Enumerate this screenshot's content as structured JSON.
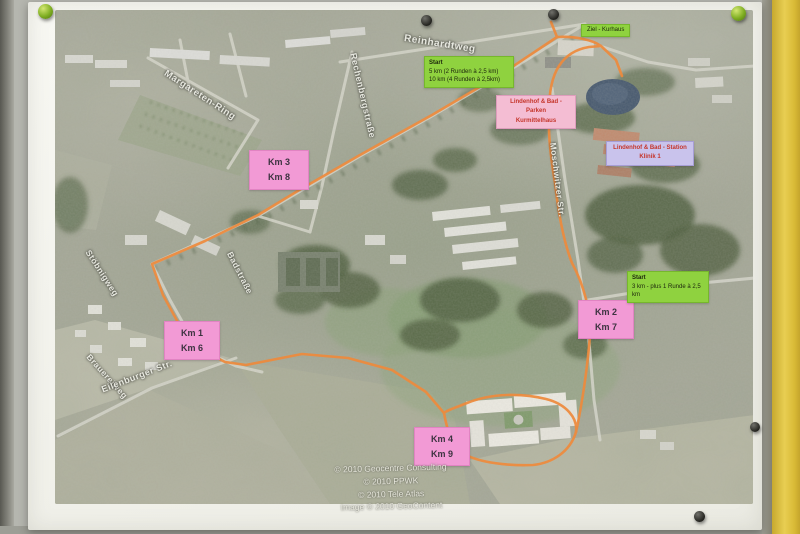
{
  "board": {
    "pins": [
      "green-pin-top-left",
      "black-pin-top-center-left",
      "black-pin-top-center-right",
      "green-pin-top-right",
      "black-pin-right-middle",
      "black-pin-bottom-right"
    ]
  },
  "map": {
    "km_markers": [
      {
        "line1": "Km 3",
        "line2": "Km 8"
      },
      {
        "line1": "Km 1",
        "line2": "Km 6"
      },
      {
        "line1": "Km 2",
        "line2": "Km 7"
      },
      {
        "line1": "Km 4",
        "line2": "Km 9"
      }
    ],
    "start_box_main": {
      "line1": "Start",
      "line2": "5 km (2 Runden à 2,5 km)",
      "line3": "10 km (4 Runden à 2,5km)"
    },
    "start_box_secondary": {
      "line1": "Start",
      "line2": "3 km - plus 1 Runde à 2,5 km"
    },
    "finish_box": {
      "label": "Ziel - Kurhaus"
    },
    "info_box_parken": {
      "line1": "Lindenhof & Bad - Parken",
      "line2": "Kurmittelhaus"
    },
    "info_box_station": {
      "line1": "Lindenhof & Bad - Station",
      "line2": "Klinik 1"
    },
    "street_labels": [
      {
        "text": "Reinhardtweg"
      },
      {
        "text": "Margareten-Ring"
      },
      {
        "text": "Rechenbergstraße"
      },
      {
        "text": "Stöbnigweg"
      },
      {
        "text": "Badstraße"
      },
      {
        "text": "Moschwitzer Str."
      },
      {
        "text": "Brauereiweg"
      },
      {
        "text": "Eilenburger Str."
      }
    ],
    "copyright": {
      "line1": "© 2010 Geocentre Consulting",
      "line2": "© 2010 PPWK",
      "line3": "© 2010 Tele Atlas",
      "line4": "Image © 2010 GeoContent"
    }
  },
  "colors": {
    "route": "#ee8a3c",
    "km_marker_bg": "#f29ad5",
    "start_bg": "#8fd23f",
    "info_parken_bg": "#f4bdd3",
    "info_station_bg": "#c9c3ec",
    "info_text": "#c5352a",
    "board_strip_yellow": "#e8ce52",
    "pond": "#46586e"
  }
}
